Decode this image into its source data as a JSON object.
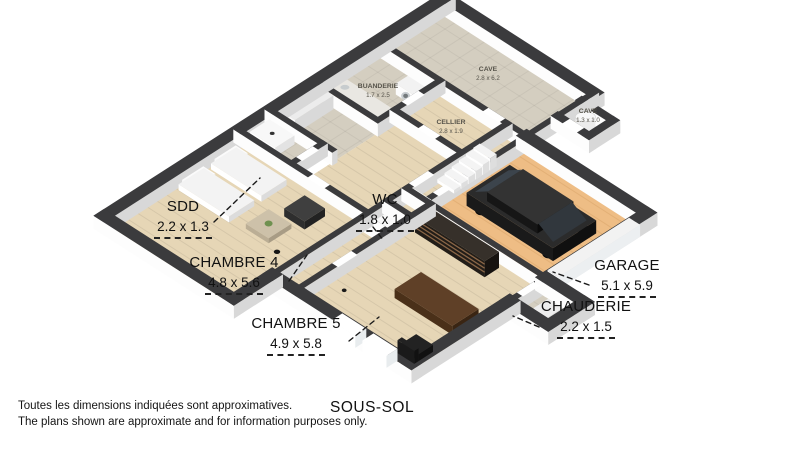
{
  "floor_title": "SOUS-SOL",
  "footer": {
    "line1": "Toutes les dimensions indiquées sont approximatives.",
    "line2": "The plans shown are approximate and for information purposes only."
  },
  "plan": {
    "callouts": [
      {
        "room": "SDD",
        "dims": "2.2 x 1.3"
      },
      {
        "room": "CHAMBRE 4",
        "dims": "4.8 x 5.6"
      },
      {
        "room": "CHAMBRE 5",
        "dims": "4.9 x 5.8"
      },
      {
        "room": "WC",
        "dims": "1.8 x 1.0"
      },
      {
        "room": "GARAGE",
        "dims": "5.1 x 5.9"
      },
      {
        "room": "CHAUDERIE",
        "dims": "2.2 x 1.5"
      }
    ],
    "floor_labels": [
      {
        "room": "CAVE",
        "dims": "2.8 x 6.2"
      },
      {
        "room": "CAVE",
        "dims": "1.3 x 1.0"
      },
      {
        "room": "BUANDERIE",
        "dims": "1.7 x 2.5"
      },
      {
        "room": "CELLIER",
        "dims": "2.8 x 1.9"
      }
    ],
    "objects": [
      "bed",
      "bed",
      "armchair",
      "coffee-table",
      "floor-lamp",
      "wardrobe",
      "shower-sink",
      "toilet",
      "washing-machine",
      "laundry-counter",
      "staircase",
      "shelving-unit",
      "desk",
      "office-chair",
      "car",
      "water-tank",
      "boiler"
    ],
    "colors": {
      "wall_top": "#3b3b3d",
      "wall_face_light": "#fdfdfd",
      "wall_face_shade": "#d8d8d8",
      "wood_floor": "#e6d6b6",
      "garage_floor": "#eebd85",
      "tile_floor": "#d4cec0",
      "car_body": "#1e1e1e",
      "label": "#111111"
    }
  }
}
